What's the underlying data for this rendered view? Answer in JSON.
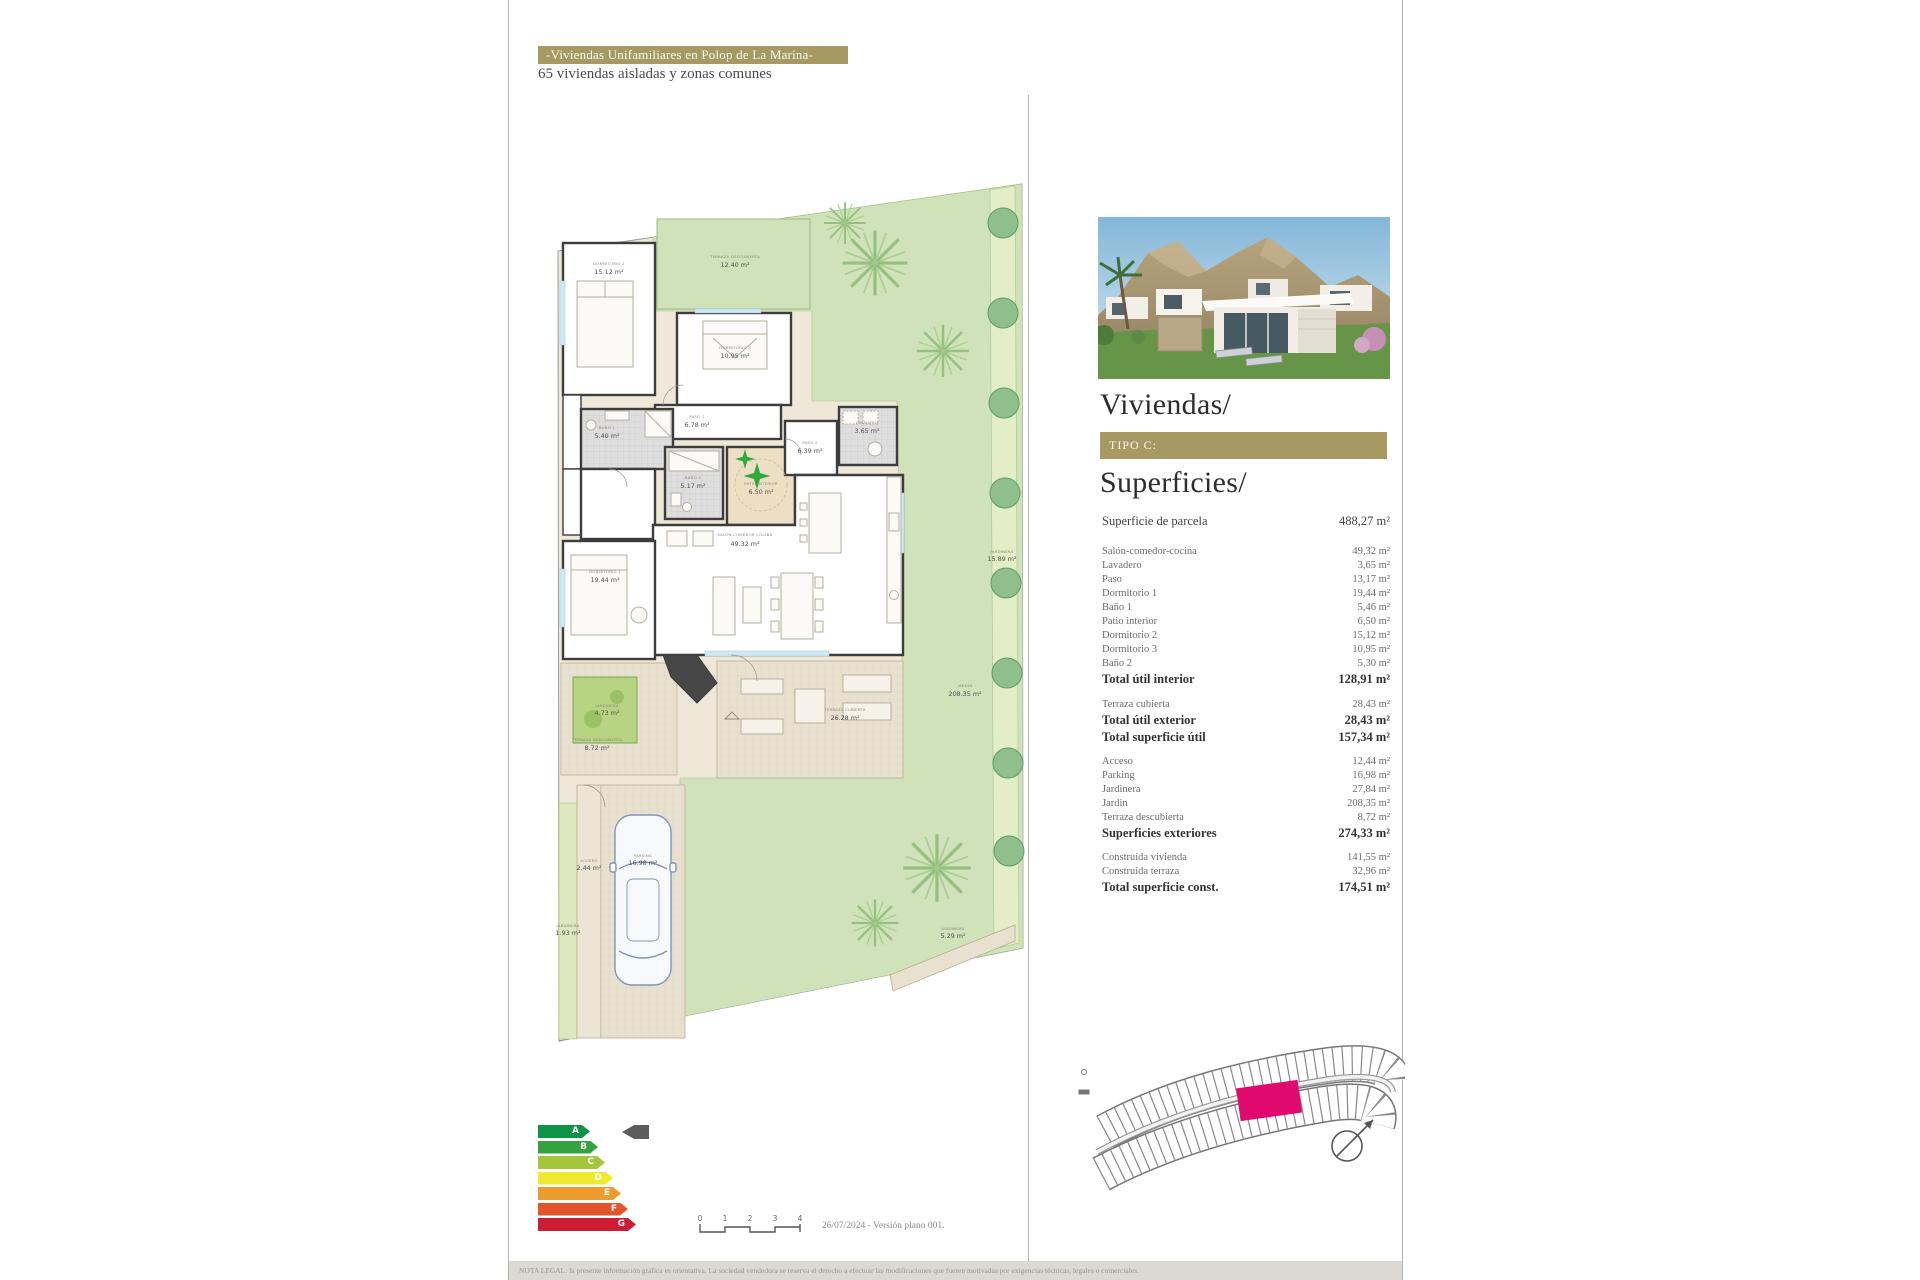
{
  "theme": {
    "gold": "#a69962",
    "magenta": "#e0096e"
  },
  "header": {
    "banner": "-Viviendas Unifamiliares en Polop de La Marina-",
    "subtitle": "65 viviendas aisladas y zonas comunes"
  },
  "panel": {
    "title": "Viviendas/",
    "tipo": "TIPO C:",
    "subtitle": "Superficies/",
    "parcela": {
      "label": "Superficie de parcela",
      "value": "488,27 m²"
    },
    "interior_rows": [
      {
        "label": "Salón-comedor-cocina",
        "value": "49,32 m²"
      },
      {
        "label": "Lavadero",
        "value": "3,65 m²"
      },
      {
        "label": "Paso",
        "value": "13,17 m²"
      },
      {
        "label": "Dormitorio 1",
        "value": "19,44 m²"
      },
      {
        "label": "Baño 1",
        "value": "5,46 m²"
      },
      {
        "label": "Patio interior",
        "value": "6,50 m²"
      },
      {
        "label": "Dormitorio 2",
        "value": "15,12 m²"
      },
      {
        "label": "Dormitorio 3",
        "value": "10,95 m²"
      },
      {
        "label": "Baño 2",
        "value": "5,30 m²"
      }
    ],
    "total_interior": {
      "label": "Total útil interior",
      "value": "128,91 m²"
    },
    "terraza_cubierta": {
      "label": "Terraza cubierta",
      "value": "28,43 m²"
    },
    "total_util_exterior": {
      "label": "Total útil exterior",
      "value": "28,43 m²"
    },
    "total_superficie_util": {
      "label": "Total superficie útil",
      "value": "157,34 m²"
    },
    "exterior_rows": [
      {
        "label": "Acceso",
        "value": "12,44 m²"
      },
      {
        "label": "Parking",
        "value": "16,98 m²"
      },
      {
        "label": "Jardinera",
        "value": "27,84 m²"
      },
      {
        "label": "Jardin",
        "value": "208,35 m²"
      },
      {
        "label": "Terraza descubierta",
        "value": "8,72 m²"
      }
    ],
    "superficies_exteriores": {
      "label": "Superficies exteriores",
      "value": "274,33 m²"
    },
    "construida_rows": [
      {
        "label": "Construida vivienda",
        "value": "141,55 m²"
      },
      {
        "label": "Construida terraza",
        "value": "32,96 m²"
      }
    ],
    "total_construida": {
      "label": "Total superficie const.",
      "value": "174,51 m²"
    }
  },
  "plan": {
    "rooms": [
      {
        "name": "DORMITORIO 2",
        "area": "15.12 m²"
      },
      {
        "name": "TERRAZA DESCUBIERTA",
        "area": "12.40 m²"
      },
      {
        "name": "DORMITORIO 3",
        "area": "10.95 m²"
      },
      {
        "name": "PASO 1",
        "area": "6.78 m²"
      },
      {
        "name": "BAÑO 1",
        "area": "5.40 m²"
      },
      {
        "name": "BAÑO 2",
        "area": "5.17 m²"
      },
      {
        "name": "PATIO INTERIOR",
        "area": "6.50 m²"
      },
      {
        "name": "SALÓN-COMEDOR COCINA",
        "area": "49.32 m²"
      },
      {
        "name": "PASO 2",
        "area": "6.39 m²"
      },
      {
        "name": "LAVADERO",
        "area": "3.65 m²"
      },
      {
        "name": "DORMITORIO 1",
        "area": "19.44 m²"
      },
      {
        "name": "JARDINERA",
        "area": "4.73 m²"
      },
      {
        "name": "TERRAZA DESCUBIERTA",
        "area": "8.72 m²"
      },
      {
        "name": "TERRAZA CUBIERTA",
        "area": "26.28 m²"
      },
      {
        "name": "JARDIN",
        "area": "208.35 m²"
      },
      {
        "name": "JARDINERA",
        "area": "15.89 m²"
      },
      {
        "name": "ACCESO",
        "area": "2.44 m²"
      },
      {
        "name": "JARDINERA",
        "area": "1.93 m²"
      },
      {
        "name": "PARKING",
        "area": "16.98 m²"
      },
      {
        "name": "JARDINERA",
        "area": "5.29 m²"
      }
    ]
  },
  "energy": {
    "grades": [
      {
        "label": "A",
        "color": "#0f9447"
      },
      {
        "label": "B",
        "color": "#35a13f"
      },
      {
        "label": "C",
        "color": "#a3c63a"
      },
      {
        "label": "D",
        "color": "#f0e92f"
      },
      {
        "label": "E",
        "color": "#eb9c2d"
      },
      {
        "label": "F",
        "color": "#e2542c"
      },
      {
        "label": "G",
        "color": "#cb1d33"
      }
    ]
  },
  "scalebar": {
    "ticks": [
      "0",
      "1",
      "2",
      "3",
      "4"
    ]
  },
  "footer": {
    "version": "26/07/2024 - Versión plano 001.",
    "legal": "NOTA LEGAL: la presente información gráfica es orientativa. La sociedad vendedora se reserva el derecho a efectuar las modificaciones que fueren motivadas por exigencias técnicas, legales o comerciales."
  }
}
